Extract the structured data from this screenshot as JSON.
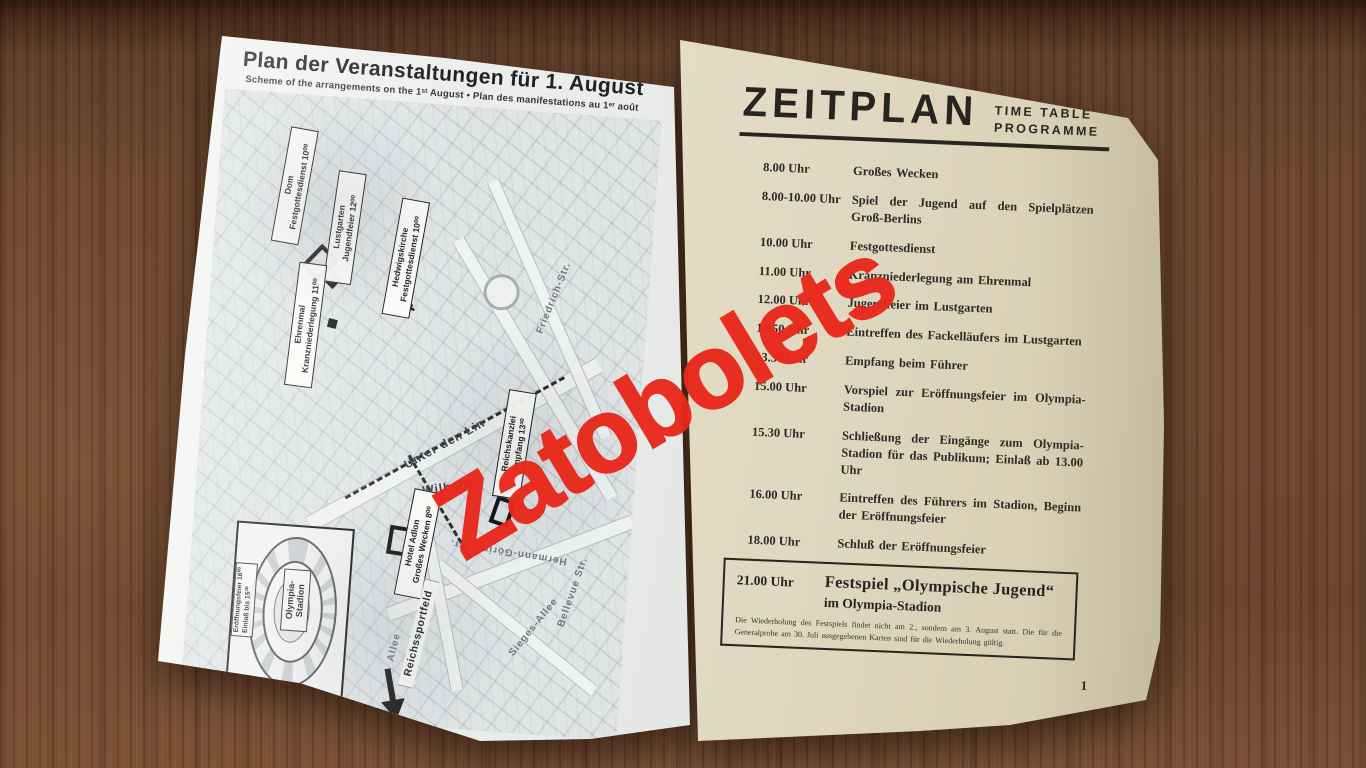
{
  "watermark": {
    "text": "Zatobolets",
    "color": "#e8291c"
  },
  "icons": {
    "church_cross": "✚"
  },
  "left_page": {
    "title": "Plan der Veranstaltungen für 1. August",
    "subtitle": "Scheme of the arrangements on the 1ˢᵗ August  •  Plan des manifestations au 1ᵉʳ août",
    "event_labels": [
      {
        "place": "Dom",
        "event": "Festgottesdienst 10⁰⁰"
      },
      {
        "place": "Lustgarten",
        "event": "Jugendfeier 12⁰⁰"
      },
      {
        "place": "Hedwigskirche",
        "event": "Festgottesdienst 10⁰⁰"
      },
      {
        "place": "Ehrenmal",
        "event": "Kranzniederlegung 11⁰⁰"
      },
      {
        "place": "Reichskanzlei",
        "event": "Empfang 13³⁰"
      },
      {
        "place": "Hotel Adlon",
        "event": "Großes Wecken 8⁰⁰"
      }
    ],
    "streets": [
      "Unter den Lin",
      "Wilhelm",
      "Friedrich-Str.",
      "Sieges-Allee",
      "Bellevue Str.",
      "Hermann-Göring-Str.",
      "Allee"
    ],
    "route_arrow": "Reichssportfeld",
    "inset": {
      "name": "Olympia-Stadion",
      "line1": "Eröffnungsfeier 16⁰⁰",
      "line2": "Einlaß bis 15³⁰"
    }
  },
  "right_page": {
    "title": "ZEITPLAN",
    "subtitle_line1": "TIME TABLE",
    "subtitle_line2": "PROGRAMME",
    "schedule": [
      {
        "time": "8.00 Uhr",
        "text": "Großes Wecken"
      },
      {
        "time": "8.00-10.00 Uhr",
        "text": "Spiel der Jugend auf den Spielplätzen Groß-Berlins"
      },
      {
        "time": "10.00 Uhr",
        "text": "Festgottesdienst"
      },
      {
        "time": "11.00 Uhr",
        "text": "Kranzniederlegung am Ehrenmal"
      },
      {
        "time": "12.00 Uhr",
        "text": "Jugendfeier im Lustgarten"
      },
      {
        "time": "12.50 Uhr",
        "text": "Eintreffen des Fackelläufers im Lustgarten"
      },
      {
        "time": "13.30 Uhr",
        "text": "Empfang beim Führer"
      },
      {
        "time": "15.00 Uhr",
        "text": "Vorspiel zur Eröffnungsfeier im Olympia-Stadion"
      },
      {
        "time": "15.30 Uhr",
        "text": "Schließung der Eingänge zum Olympia-Stadion für das Publikum; Einlaß ab 13.00 Uhr"
      },
      {
        "time": "16.00 Uhr",
        "text": "Eintreffen des Führers im Stadion, Beginn der Eröffnungsfeier"
      },
      {
        "time": "18.00 Uhr",
        "text": "Schluß der Eröffnungsfeier"
      }
    ],
    "highlight": {
      "time": "21.00 Uhr",
      "title": "Festspiel „Olympische Jugend“",
      "subtitle": "im Olympia-Stadion",
      "note": "Die Wiederholung des Festspiels findet nicht am 2., sondern am 3. August statt. Die für die Generalprobe am 30. Juli ausgegebenen Karten sind für die Wiederholung gültig."
    },
    "page_number": "1"
  }
}
